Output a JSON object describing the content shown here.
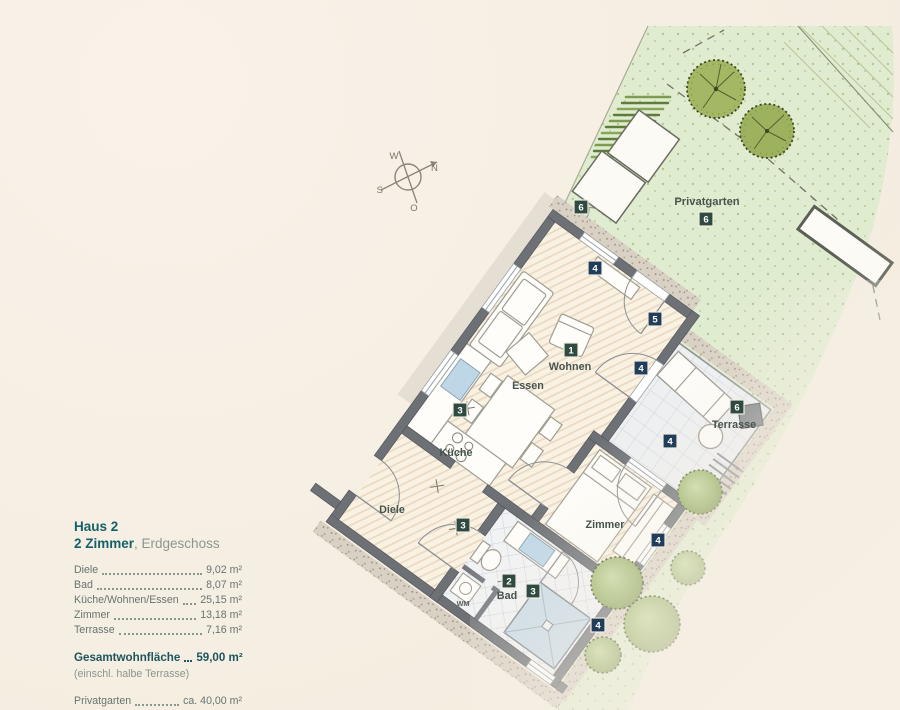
{
  "legend": {
    "title": "Haus 2",
    "subtitle_bold": "2 Zimmer",
    "subtitle_rest": ", Erdgeschoss",
    "rooms": [
      {
        "label": "Diele",
        "value": "9,02 m²"
      },
      {
        "label": "Bad",
        "value": "8,07 m²"
      },
      {
        "label": "Küche/Wohnen/Essen",
        "value": "25,15 m²"
      },
      {
        "label": "Zimmer",
        "value": "13,18 m²"
      },
      {
        "label": "Terrasse",
        "value": "7,16 m²"
      }
    ],
    "total_label": "Gesamtwohnfläche",
    "total_value": "59,00 m²",
    "total_note": "(einschl. halbe Terrasse)",
    "garden_label": "Privatgarten",
    "garden_value": "ca. 40,00 m²"
  },
  "plan": {
    "labels": {
      "wohnen": "Wohnen",
      "essen": "Essen",
      "kueche": "Küche",
      "diele": "Diele",
      "zimmer": "Zimmer",
      "bad": "Bad",
      "wm": "WM",
      "terrasse": "Terrasse",
      "privatgarten": "Privatgarten"
    },
    "badges": {
      "n1": "1",
      "n2": "2",
      "n3": "3",
      "n4": "4",
      "n5": "5",
      "n6": "6"
    },
    "compass": {
      "n": "N",
      "o": "O",
      "s": "S",
      "w": "W"
    },
    "colors": {
      "badge_room": "#2e4a41",
      "badge_window": "#203d5a",
      "garden_green": "#e0eccf",
      "wall_gray": "#6d7176",
      "accent_text": "#16606a"
    }
  }
}
